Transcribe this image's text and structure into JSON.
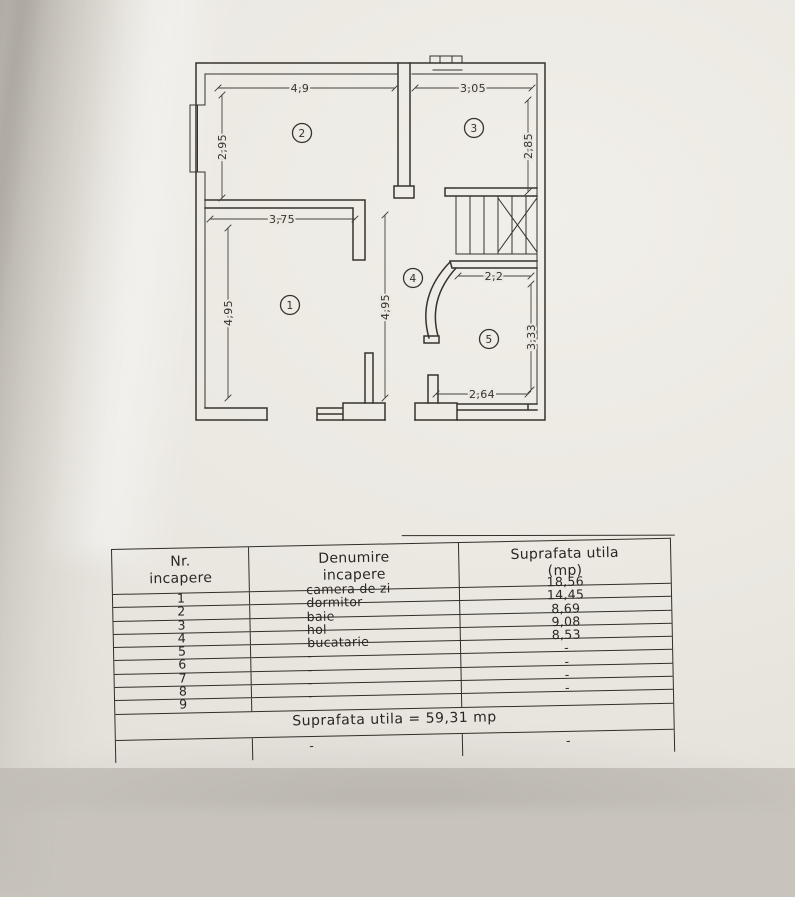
{
  "plan": {
    "rooms": [
      "1",
      "2",
      "3",
      "4",
      "5"
    ],
    "dims": {
      "room2_width": "4,9",
      "room3_width": "3,05",
      "room2_height": "2,95",
      "room3_height": "2,85",
      "room1_width": "3,75",
      "room1_height": "4,95",
      "hall_height": "4,95",
      "room5_width_top": "2,2",
      "room5_height": "3,33",
      "room5_width_bottom": "2,64"
    }
  },
  "table": {
    "headers": {
      "nr": "Nr.\nincapere",
      "denumire": "Denumire\nincapere",
      "suprafata": "Suprafata utila\n(mp)"
    },
    "rows": [
      {
        "nr": "1",
        "name": "camera de zi",
        "area": "18,56"
      },
      {
        "nr": "2",
        "name": "dormitor",
        "area": "14,45"
      },
      {
        "nr": "3",
        "name": "baie",
        "area": "8,69"
      },
      {
        "nr": "4",
        "name": "hol",
        "area": "9,08"
      },
      {
        "nr": "5",
        "name": "bucatarie",
        "area": "8,53"
      },
      {
        "nr": "6",
        "name": "-",
        "area": "-"
      },
      {
        "nr": "7",
        "name": "-",
        "area": "-"
      },
      {
        "nr": "8",
        "name": "-",
        "area": "-"
      },
      {
        "nr": "9",
        "name": "-",
        "area": "-"
      }
    ],
    "total": "Suprafata utila = 59,31 mp",
    "extra_row": {
      "name": "-",
      "area": "-"
    }
  },
  "colors": {
    "ink": "#36332d",
    "paper": "#ebe8e2"
  }
}
